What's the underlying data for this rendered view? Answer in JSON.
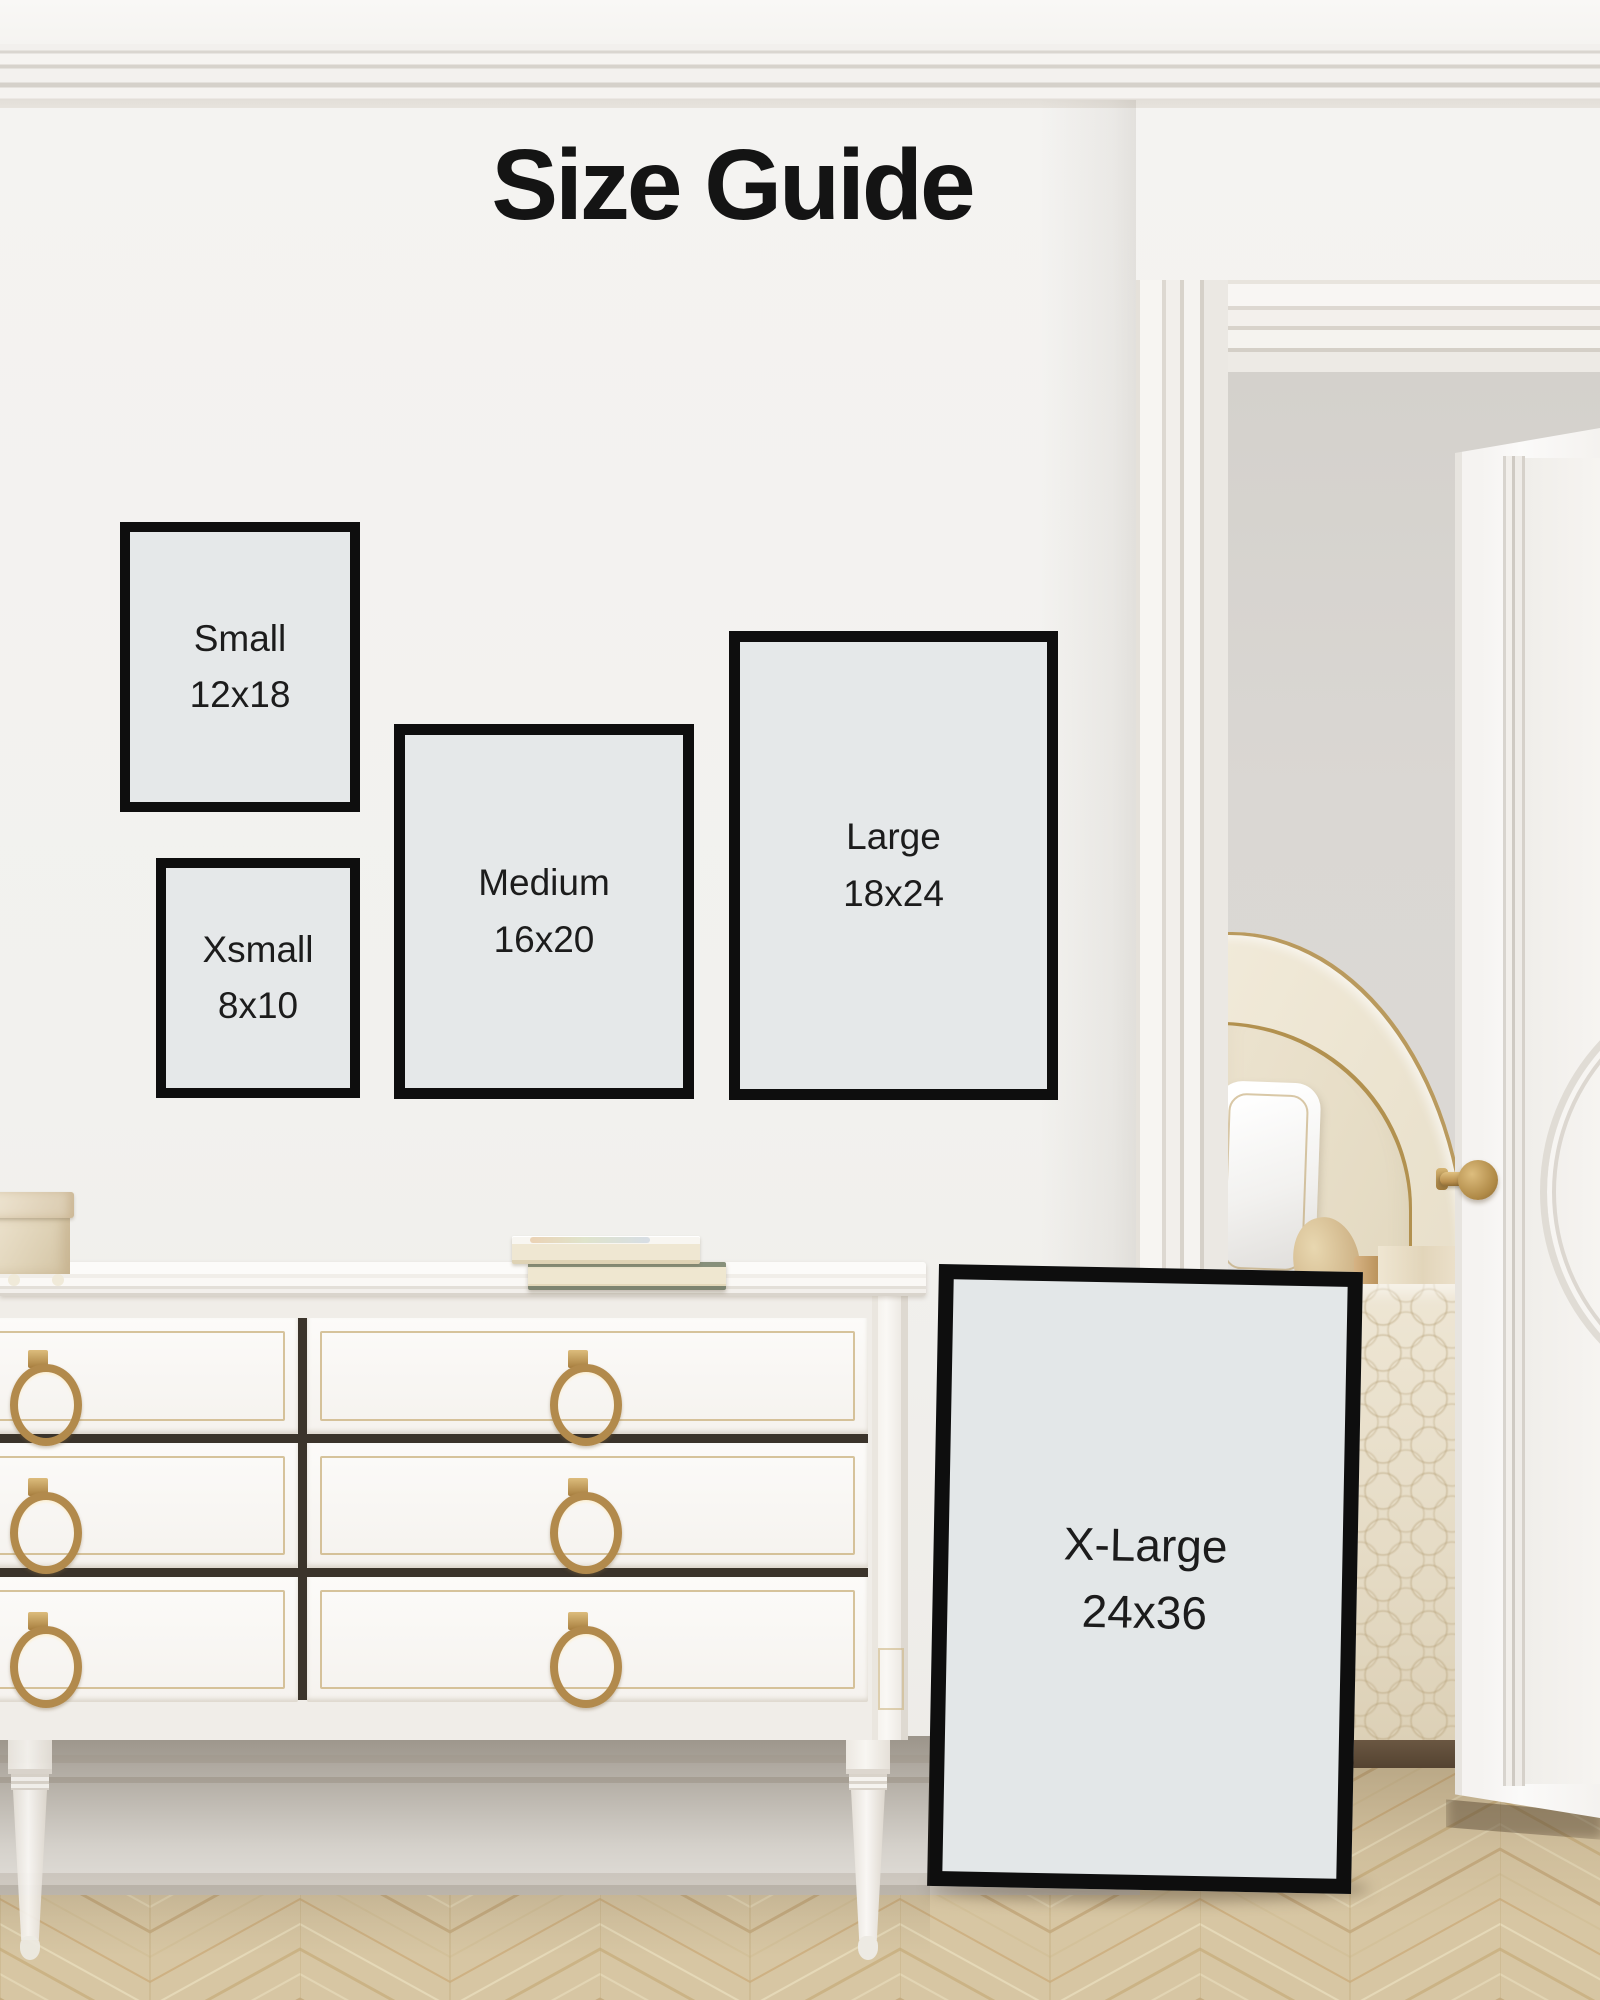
{
  "title": "Size Guide",
  "sizes": [
    {
      "id": "xsmall",
      "label": "Xsmall",
      "dimensions": "8x10"
    },
    {
      "id": "small",
      "label": "Small",
      "dimensions": "12x18"
    },
    {
      "id": "medium",
      "label": "Medium",
      "dimensions": "16x20"
    },
    {
      "id": "large",
      "label": "Large",
      "dimensions": "18x24"
    },
    {
      "id": "xlarge",
      "label": "X-Large",
      "dimensions": "24x36"
    }
  ],
  "colors": {
    "frame_border": "#0e0e0e",
    "frame_matte": "#e5e8e9",
    "title_text": "#141414",
    "wall": "#f3f2f0",
    "accent_brass": "#b28a4c",
    "floor_wood": "#d7c6a3"
  }
}
